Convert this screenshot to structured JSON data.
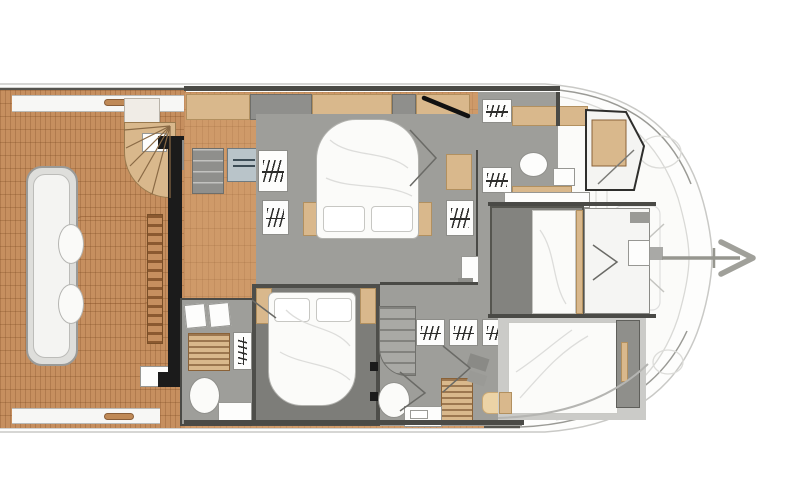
{
  "meta": {
    "title": "Catamaran motor yacht deck floor plan",
    "view": "top-down naval architecture layout, bow pointing right, no on-screen text"
  },
  "palette": {
    "teak": "#c68f5f",
    "wood-floor": "#cf9a69",
    "cabinet-wood": "#d9b88c",
    "cabinet-wood-border": "#b2905f",
    "floor": "#9e9e9a",
    "floor-light": "#cbcbc8",
    "white-room": "#f5f5f3",
    "wall": "#4a4a46",
    "black": "#1b1b1b",
    "gray-unit": "#8f8f8c",
    "washer": "#b9c4c9",
    "washer-border": "#6f7a80",
    "bed-white": "#fbfbf9",
    "bed-border": "#b2b2ae",
    "hull-line": "#c9c9c6",
    "gunwale": "#55544f",
    "faint": "#dcdcd9"
  },
  "areas": {
    "aft_deck": "aft cockpit with teak sole, transom bench, spiral stairs",
    "galley": "drawer unit, washing machine, hanging locker",
    "master_cabin": "centre double bed with two pillows, wardrobes and nightstands",
    "guest_cabin_aft": "double bed facing forward with two pillows",
    "corridor": "three hanging lockers, stairs down, head with toilet, shower grate, vanity",
    "aft_head": "shower grate, hanging locker, toilet, vanity",
    "fwd_head": "twin hanging lockers, round sink, shower compartment",
    "fwd_cabin_port": "athwartships berth with timber trim",
    "fwd_cabin_bow": "berth against curved hull with grey headboard",
    "bow": "foredeck, windlass and anchor"
  },
  "icons": [
    "hanging-locker-icon",
    "toilet-icon",
    "sink-icon",
    "anchor-icon",
    "washing-machine-icon",
    "stairs-icon",
    "shower-grate-icon",
    "cleat-icon"
  ]
}
